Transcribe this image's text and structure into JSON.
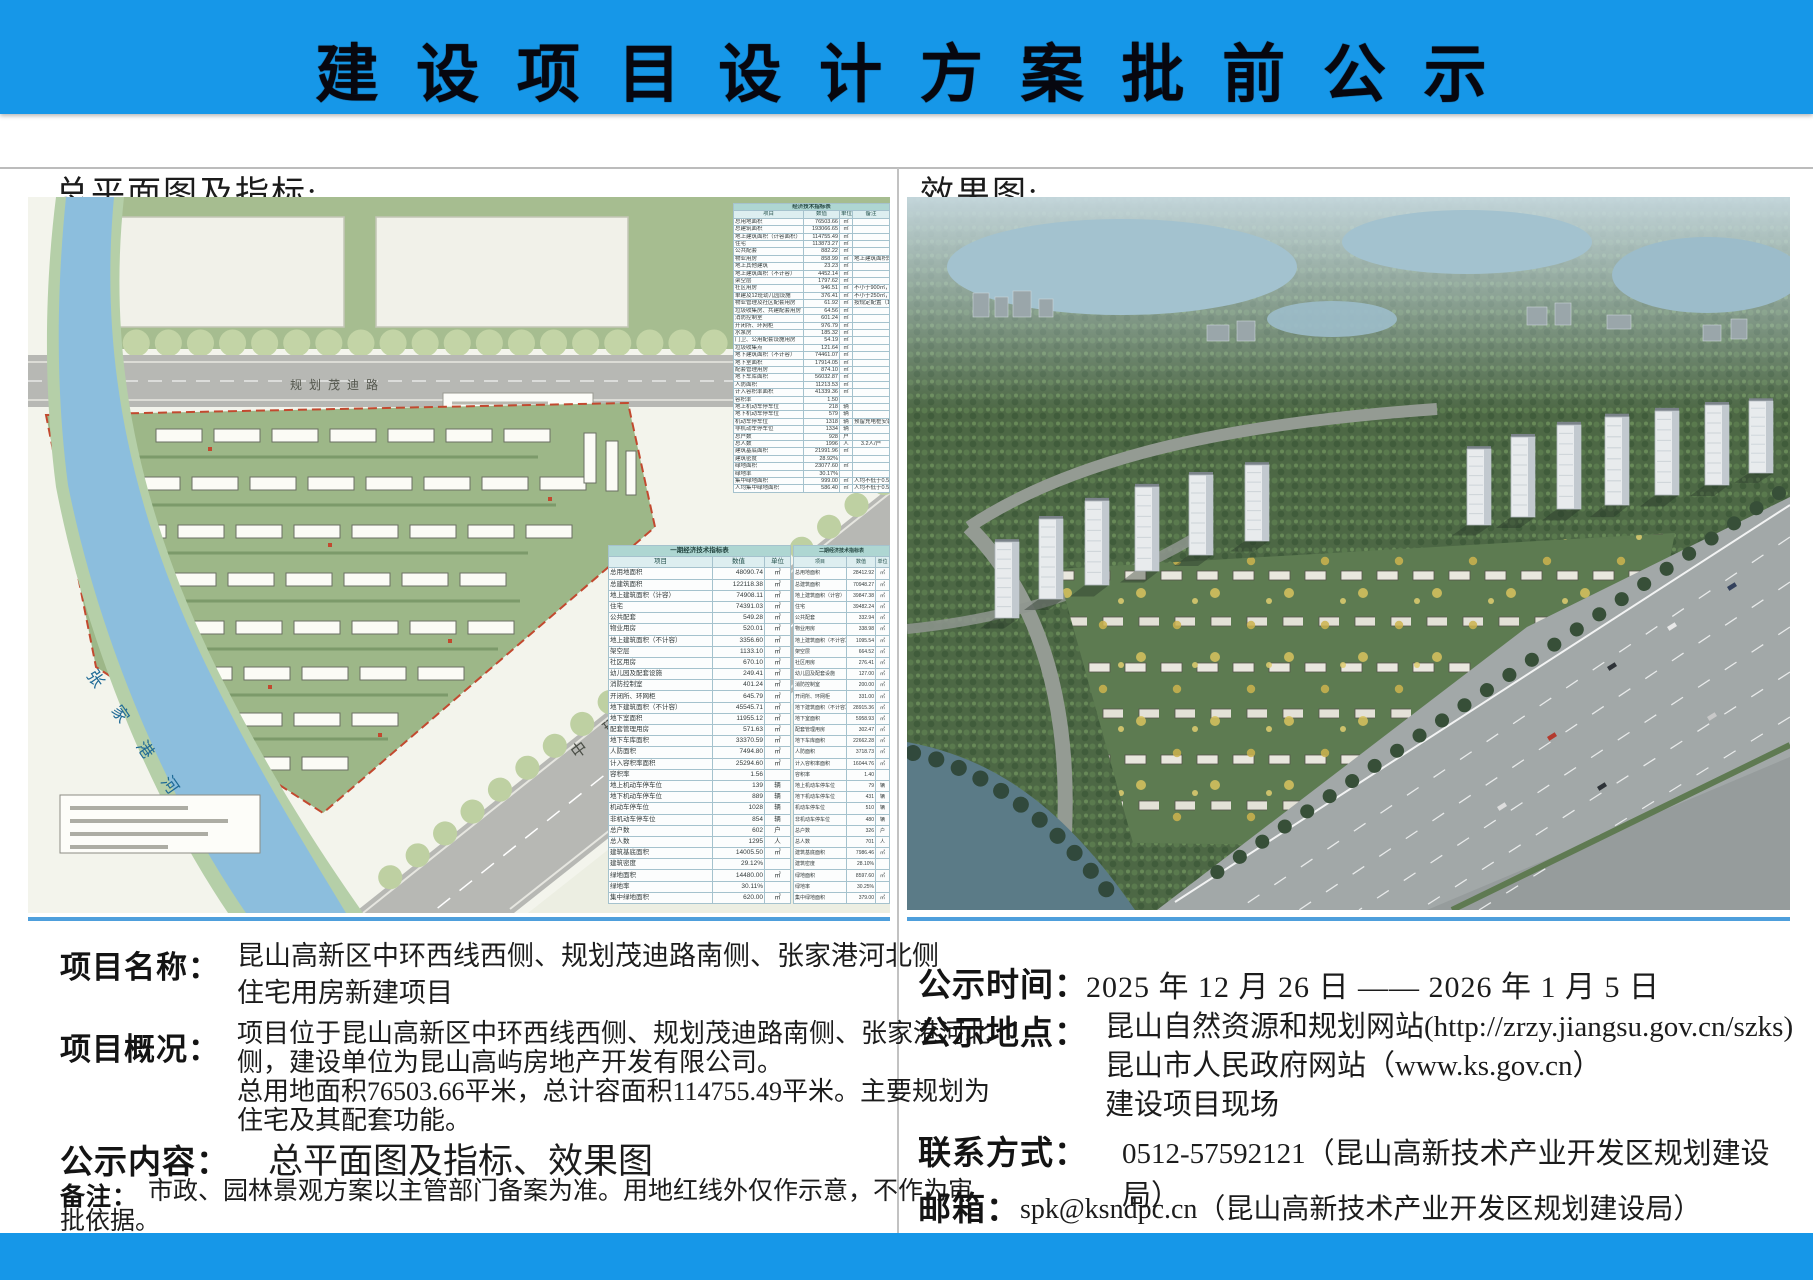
{
  "page": {
    "title": "建 设 项 目 设 计 方 案 批 前 公 示",
    "accent_color": "#1697e8"
  },
  "left_panel": {
    "header": "总平面图及指标:",
    "site_plan": {
      "top_road_label": "规划茂迪路",
      "diagonal_road_label": "中 环 西 线",
      "river_label": "张 家 港 河"
    },
    "main_table": {
      "title": "经济技术指标表",
      "columns": [
        "项目",
        "数值",
        "单位",
        "备注"
      ],
      "rows": [
        [
          "总用地面积",
          "76503.66",
          "㎡",
          ""
        ],
        [
          "总建筑面积",
          "193066.65",
          "㎡",
          ""
        ],
        [
          "地上建筑面积（计容面积）",
          "114755.49",
          "㎡",
          ""
        ],
        [
          "住宅",
          "113873.27",
          "㎡",
          ""
        ],
        [
          "公共配套",
          "882.22",
          "㎡",
          ""
        ],
        [
          "物业用房",
          "858.99",
          "㎡",
          "地上建筑面积的0.75%"
        ],
        [
          "地上其他建筑",
          "23.23",
          "㎡",
          ""
        ],
        [
          "地上建筑面积（不计容）",
          "4452.14",
          "㎡",
          ""
        ],
        [
          "架空层",
          "1797.62",
          "㎡",
          ""
        ],
        [
          "社区用房",
          "946.51",
          "㎡",
          "不小于900㎡，沿入口道路设置"
        ],
        [
          "单建及12班幼儿园设施",
          "376.41",
          "㎡",
          "不小于250㎡，按规定配建管理用房"
        ],
        [
          "物业管理及社区配套用房",
          "61.92",
          "㎡",
          "按规定配置（100%）2处"
        ],
        [
          "垃圾收集房、共建配套用房",
          "64.56",
          "㎡",
          ""
        ],
        [
          "消防控制室",
          "601.24",
          "㎡",
          ""
        ],
        [
          "开闭所、环网柜",
          "976.79",
          "㎡",
          ""
        ],
        [
          "水泵房",
          "185.32",
          "㎡",
          ""
        ],
        [
          "门卫、公用配套设施用房",
          "54.19",
          "㎡",
          ""
        ],
        [
          "垃圾收集点",
          "121.64",
          "㎡",
          ""
        ],
        [
          "地下建筑面积（不计容）",
          "74461.07",
          "㎡",
          ""
        ],
        [
          "地下室面积",
          "17914.05",
          "㎡",
          ""
        ],
        [
          "配套管理用房",
          "874.10",
          "㎡",
          ""
        ],
        [
          "地下车库面积",
          "56032.87",
          "㎡",
          ""
        ],
        [
          "人防面积",
          "11213.53",
          "㎡",
          ""
        ],
        [
          "计入容积率面积",
          "41339.36",
          "㎡",
          ""
        ],
        [
          "容积率",
          "1.50",
          "",
          ""
        ],
        [
          "地上机动车停车位",
          "218",
          "辆",
          ""
        ],
        [
          "地下机动车停车位",
          "579",
          "辆",
          ""
        ],
        [
          "机动车停车位",
          "1318",
          "辆",
          "预留充电桩安装条件"
        ],
        [
          "非机动车停车位",
          "1334",
          "辆",
          ""
        ],
        [
          "总户数",
          "928",
          "户",
          ""
        ],
        [
          "总人数",
          "1996",
          "人",
          "3.2人/户"
        ],
        [
          "建筑基底面积",
          "21991.96",
          "㎡",
          ""
        ],
        [
          "建筑密度",
          "28.92%",
          "",
          ""
        ],
        [
          "绿地面积",
          "23077.60",
          "㎡",
          ""
        ],
        [
          "绿地率",
          "30.17%",
          "",
          ""
        ],
        [
          "集中绿地面积",
          "999.00",
          "㎡",
          "人均不低于0.5平方米"
        ],
        [
          "人均集中绿地面积",
          "586.40",
          "㎡",
          "人均不低于0.5平方米"
        ]
      ]
    },
    "phase_tables": [
      {
        "title": "一期经济技术指标表",
        "columns": [
          "项目",
          "数值",
          "单位"
        ],
        "rows": [
          [
            "总用地面积",
            "48090.74",
            "㎡"
          ],
          [
            "总建筑面积",
            "122118.38",
            "㎡"
          ],
          [
            "地上建筑面积（计容）",
            "74908.11",
            "㎡"
          ],
          [
            "住宅",
            "74391.03",
            "㎡"
          ],
          [
            "公共配套",
            "549.28",
            "㎡"
          ],
          [
            "物业用房",
            "520.01",
            "㎡"
          ],
          [
            "地上建筑面积（不计容）",
            "3356.60",
            "㎡"
          ],
          [
            "架空层",
            "1133.10",
            "㎡"
          ],
          [
            "社区用房",
            "670.10",
            "㎡"
          ],
          [
            "幼儿园及配套设施",
            "249.41",
            "㎡"
          ],
          [
            "消防控制室",
            "401.24",
            "㎡"
          ],
          [
            "开闭所、环网柜",
            "645.79",
            "㎡"
          ],
          [
            "地下建筑面积（不计容）",
            "45545.71",
            "㎡"
          ],
          [
            "地下室面积",
            "11955.12",
            "㎡"
          ],
          [
            "配套管理用房",
            "571.63",
            "㎡"
          ],
          [
            "地下车库面积",
            "33370.59",
            "㎡"
          ],
          [
            "人防面积",
            "7494.80",
            "㎡"
          ],
          [
            "计入容积率面积",
            "25294.60",
            "㎡"
          ],
          [
            "容积率",
            "1.56",
            ""
          ],
          [
            "地上机动车停车位",
            "139",
            "辆"
          ],
          [
            "地下机动车停车位",
            "889",
            "辆"
          ],
          [
            "机动车停车位",
            "1028",
            "辆"
          ],
          [
            "非机动车停车位",
            "854",
            "辆"
          ],
          [
            "总户数",
            "602",
            "户"
          ],
          [
            "总人数",
            "1295",
            "人"
          ],
          [
            "建筑基底面积",
            "14005.50",
            "㎡"
          ],
          [
            "建筑密度",
            "29.12%",
            ""
          ],
          [
            "绿地面积",
            "14480.00",
            "㎡"
          ],
          [
            "绿地率",
            "30.11%",
            ""
          ],
          [
            "集中绿地面积",
            "620.00",
            "㎡"
          ]
        ]
      },
      {
        "title": "二期经济技术指标表",
        "columns": [
          "项目",
          "数值",
          "单位"
        ],
        "rows": [
          [
            "总用地面积",
            "28412.92",
            "㎡"
          ],
          [
            "总建筑面积",
            "70948.27",
            "㎡"
          ],
          [
            "地上建筑面积（计容）",
            "39847.38",
            "㎡"
          ],
          [
            "住宅",
            "39482.24",
            "㎡"
          ],
          [
            "公共配套",
            "332.94",
            "㎡"
          ],
          [
            "物业用房",
            "338.98",
            "㎡"
          ],
          [
            "地上建筑面积（不计容）",
            "1095.54",
            "㎡"
          ],
          [
            "架空层",
            "664.52",
            "㎡"
          ],
          [
            "社区用房",
            "276.41",
            "㎡"
          ],
          [
            "幼儿园及配套设施",
            "127.00",
            "㎡"
          ],
          [
            "消防控制室",
            "200.00",
            "㎡"
          ],
          [
            "开闭所、环网柜",
            "331.00",
            "㎡"
          ],
          [
            "地下建筑面积（不计容）",
            "28915.36",
            "㎡"
          ],
          [
            "地下室面积",
            "5958.93",
            "㎡"
          ],
          [
            "配套管理用房",
            "302.47",
            "㎡"
          ],
          [
            "地下车库面积",
            "22662.28",
            "㎡"
          ],
          [
            "人防面积",
            "3718.73",
            "㎡"
          ],
          [
            "计入容积率面积",
            "16044.76",
            "㎡"
          ],
          [
            "容积率",
            "1.40",
            ""
          ],
          [
            "地上机动车停车位",
            "79",
            "辆"
          ],
          [
            "地下机动车停车位",
            "431",
            "辆"
          ],
          [
            "机动车停车位",
            "510",
            "辆"
          ],
          [
            "非机动车停车位",
            "480",
            "辆"
          ],
          [
            "总户数",
            "326",
            "户"
          ],
          [
            "总人数",
            "701",
            "人"
          ],
          [
            "建筑基底面积",
            "7986.46",
            "㎡"
          ],
          [
            "建筑密度",
            "28.10%",
            ""
          ],
          [
            "绿地面积",
            "8597.60",
            "㎡"
          ],
          [
            "绿地率",
            "30.25%",
            ""
          ],
          [
            "集中绿地面积",
            "379.00",
            "㎡"
          ]
        ]
      }
    ]
  },
  "right_panel": {
    "header": "效果图:"
  },
  "details_left": {
    "project_name_label": "项目名称：",
    "project_name_lines": [
      "昆山高新区中环西线西侧、规划茂迪路南侧、张家港河北侧",
      "住宅用房新建项目"
    ],
    "overview_label": "项目概况：",
    "overview_lines": [
      "项目位于昆山高新区中环西线西侧、规划茂迪路南侧、张家港河北",
      "侧，建设单位为昆山高屿房地产开发有限公司。",
      "总用地面积76503.66平米，总计容面积114755.49平米。主要规划为",
      "住宅及其配套功能。"
    ],
    "content_label": "公示内容：",
    "content_value": "总平面图及指标、效果图",
    "note_label": "备注：",
    "note_lines": [
      "市政、园林景观方案以主管部门备案为准。用地红线外仅作示意，不作为审",
      "批依据。"
    ]
  },
  "details_right": {
    "time_label": "公示时间：",
    "time_value": "2025 年 12 月 26 日 —— 2026 年 1 月 5 日",
    "place_label": "公示地点：",
    "place_lines": [
      "昆山自然资源和规划网站(http://zrzy.jiangsu.gov.cn/szks)",
      "昆山市人民政府网站（www.ks.gov.cn）",
      "建设项目现场"
    ],
    "contact_label": "联系方式：",
    "contact_value": "0512-57592121（昆山高新技术产业开发区规划建设局）",
    "email_label": "邮箱：",
    "email_value": "spk@ksndpc.cn（昆山高新技术产业开发区规划建设局）"
  }
}
